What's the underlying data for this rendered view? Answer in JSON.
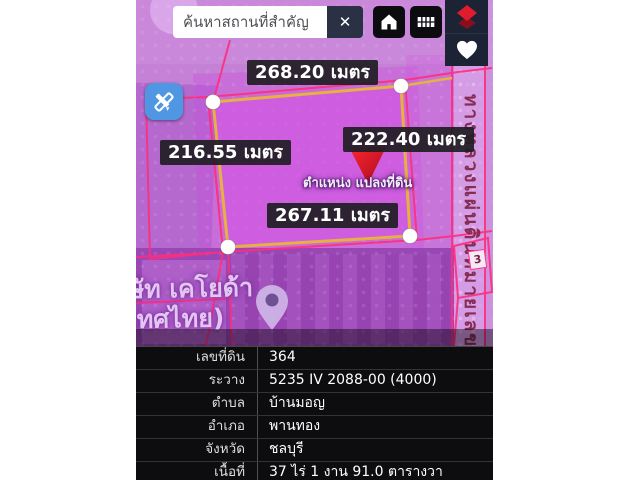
{
  "app": {
    "search": {
      "placeholder": "ค้นหาสถานที่สำคัญ",
      "value": "",
      "clear": "✕"
    },
    "map": {
      "measurements": {
        "top": "268.20 เมตร",
        "right": "222.40 เมตร",
        "left": "216.55 เมตร",
        "bottom": "267.11 เมตร"
      },
      "marker_label": "ตำแหน่ง แปลงที่ดิน",
      "road_label": "ทางหลวงแผ่นดินหมายเลข",
      "place_label": {
        "line1": "ษัท เคโยด้า",
        "line2": "เทศไทย)"
      },
      "parcel_badge": "3"
    },
    "info_table": {
      "rows": [
        {
          "label": "เลขที่ดิน",
          "value": "364"
        },
        {
          "label": "ระวาง",
          "value": "5235 IV 2088-00 (4000)"
        },
        {
          "label": "ตำบล",
          "value": "บ้านมอญ"
        },
        {
          "label": "อำเภอ",
          "value": "พานทอง"
        },
        {
          "label": "จังหวัด",
          "value": "ชลบุรี"
        },
        {
          "label": "เนื้อที่",
          "value": "37 ไร่ 1 งาน 91.0 ตารางวา"
        }
      ]
    },
    "colors": {
      "accent_blue": "#4f97e3",
      "pin_red": "#e8192c",
      "plot_border_yellow": "#e7b042",
      "cadastral_pink": "#ff2e7e",
      "panel_dark": "#1b2335",
      "chip_dark": "#221f26"
    }
  }
}
